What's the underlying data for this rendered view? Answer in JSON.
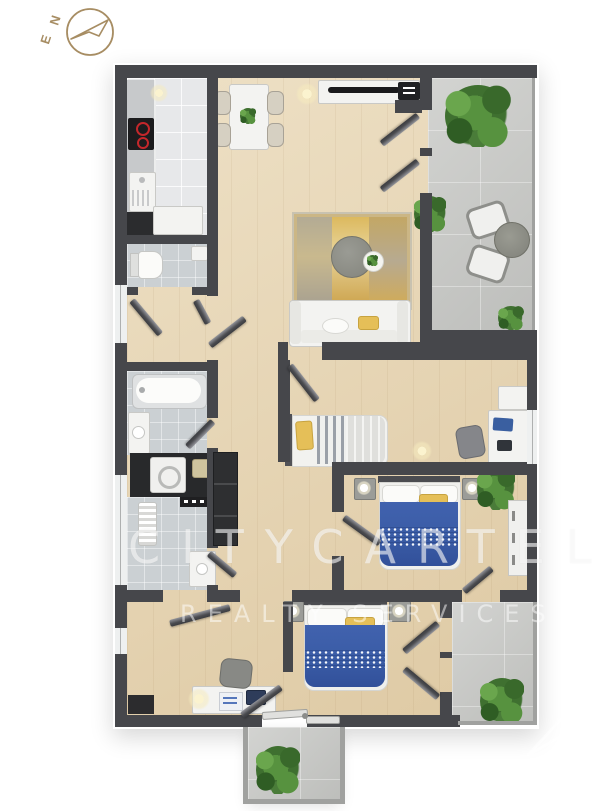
{
  "compass": {
    "north": "N",
    "east": "E",
    "color": "#a78d63"
  },
  "watermark": {
    "line1": "CITYCARTEL",
    "line2": "REALTY SERVICES"
  },
  "palette": {
    "wall": "#46474b",
    "wood_floor": "#e8d6b2",
    "bath_tile": "#cbd0d3",
    "kitchen_tile": "#e7e8ea",
    "concrete": "#c9cac7",
    "accent_blue": "#3a5ca6",
    "accent_yellow": "#e5bf58",
    "plant_green": "#4a7c39",
    "burner_red": "#c4272b",
    "compass_tan": "#a78d63"
  }
}
